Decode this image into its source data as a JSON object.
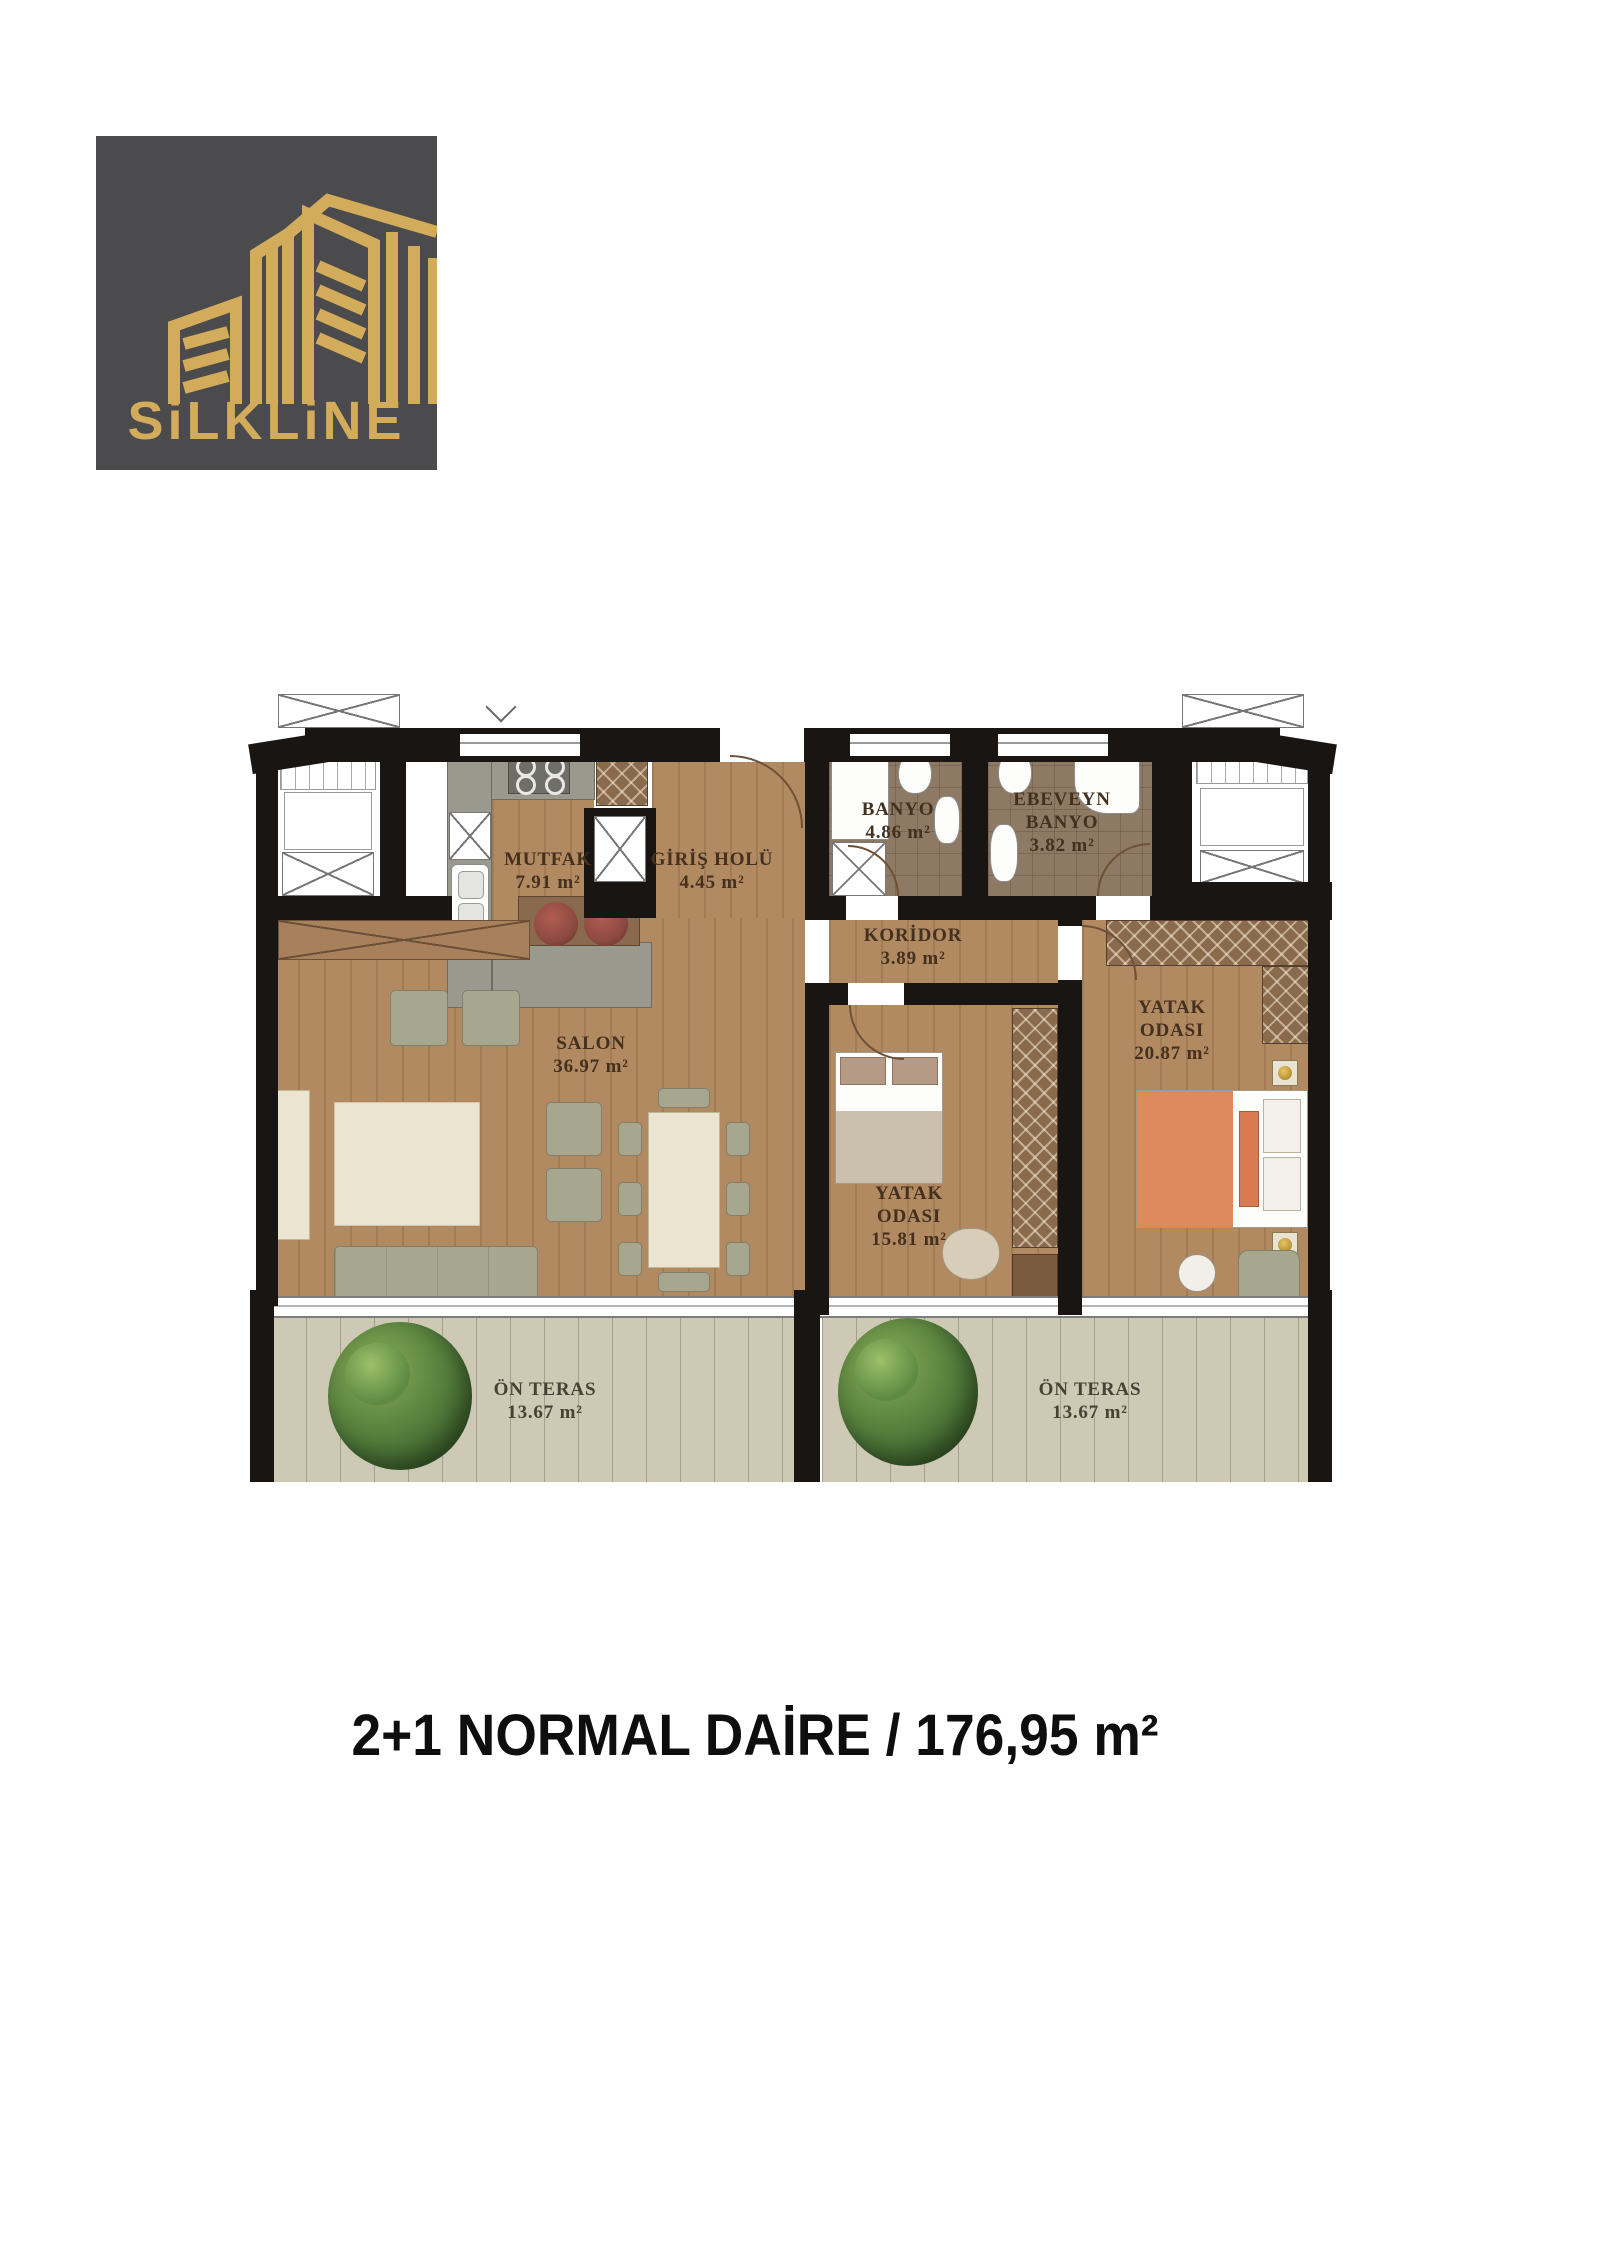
{
  "logo": {
    "brand": "SiLKLiNE"
  },
  "caption": {
    "text": "2+1 NORMAL DAİRE / 176,95 m²"
  },
  "plan": {
    "rooms": {
      "mutfak": {
        "name": "MUTFAK",
        "area": "7.91 m²"
      },
      "giris_holu": {
        "name": "GİRİŞ HOLÜ",
        "area": "4.45 m²"
      },
      "banyo": {
        "name": "BANYO",
        "area": "4.86 m²"
      },
      "ebeveyn_banyo": {
        "line1": "EBEVEYN",
        "line2": "BANYO",
        "area": "3.82 m²"
      },
      "koridor": {
        "name": "KORİDOR",
        "area": "3.89 m²"
      },
      "salon": {
        "name": "SALON",
        "area": "36.97 m²"
      },
      "yatak_odasi_1": {
        "line1": "YATAK",
        "line2": "ODASI",
        "area": "20.87 m²"
      },
      "yatak_odasi_2": {
        "line1": "YATAK",
        "line2": "ODASI",
        "area": "15.81 m²"
      },
      "on_teras_sol": {
        "name": "ÖN TERAS",
        "area": "13.67 m²"
      },
      "on_teras_sag": {
        "name": "ÖN TERAS",
        "area": "13.67 m²"
      }
    }
  },
  "colors": {
    "logo_bg": "#4b4a4c",
    "brand_gold": "#d2ab5b",
    "wall": "#191512",
    "wood_floor": "#b18a62",
    "bath_tile": "#8e7a64",
    "terrace_floor": "#cdc9b5",
    "kitchen_counter": "#9a998e",
    "sofa_sage": "#a7a68e",
    "bed_blanket_orange": "#df8a5e",
    "stool_red": "#8d4a42",
    "tree_green": "#50793a",
    "label_text": "#44301e"
  }
}
